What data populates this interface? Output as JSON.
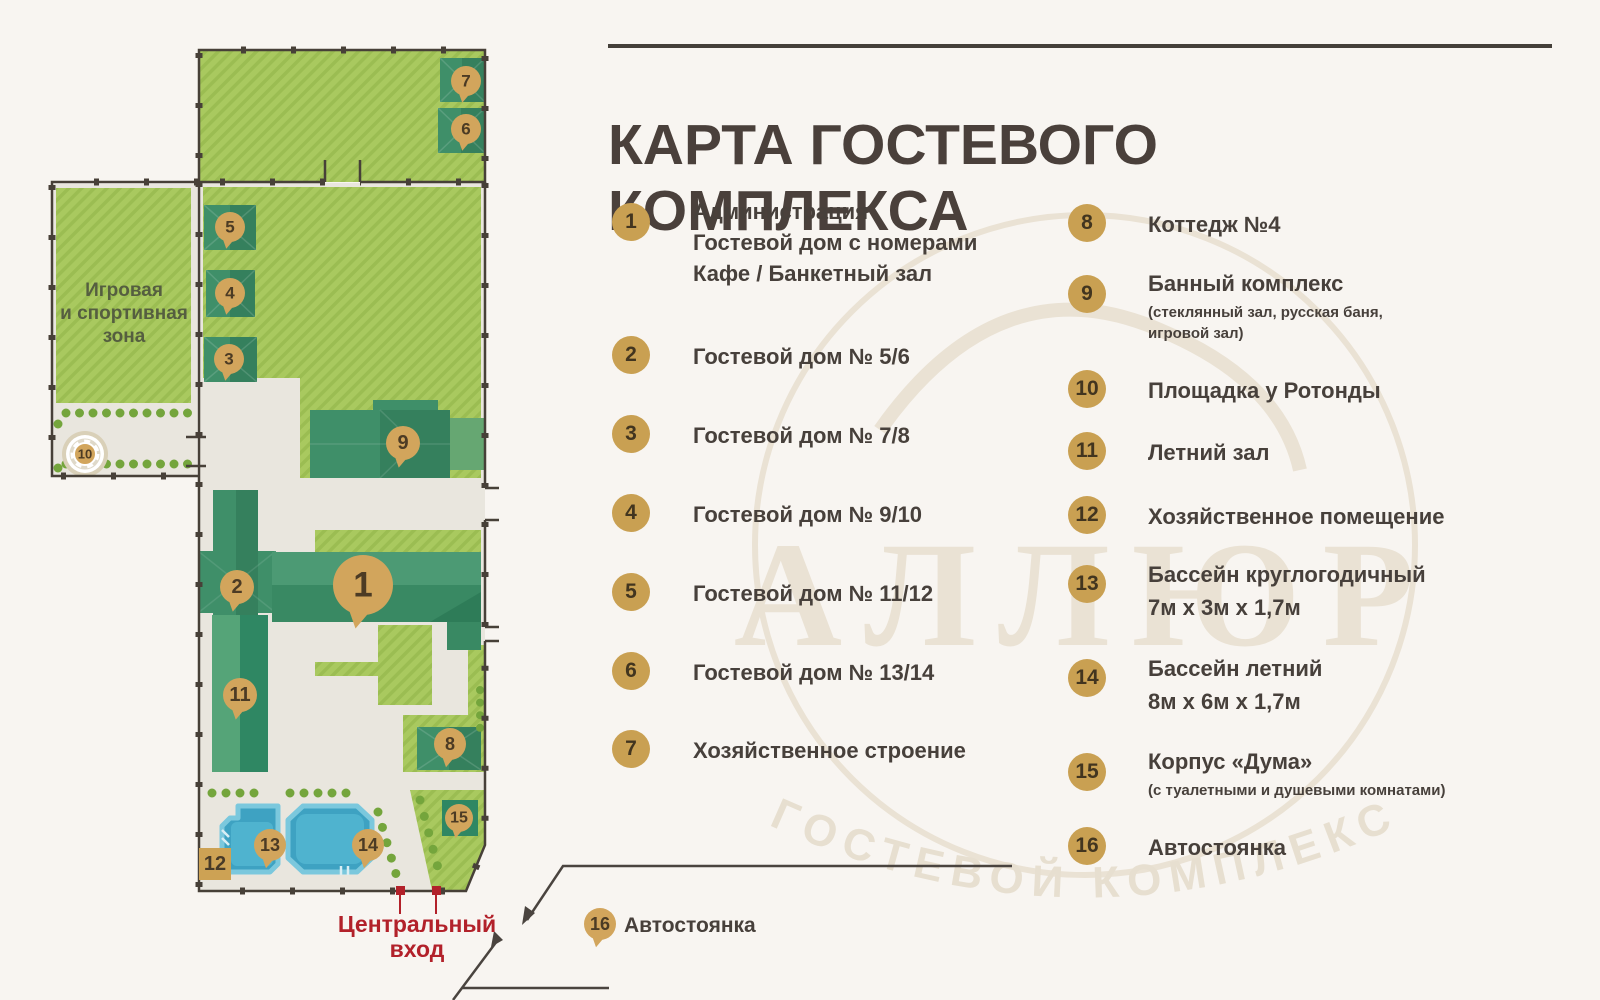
{
  "header": {
    "title": "КАРТА ГОСТЕВОГО КОМПЛЕКСА"
  },
  "map": {
    "zone_label": {
      "line1": "Игровая",
      "line2": "и спортивная",
      "line3": "зона"
    },
    "entrance": {
      "line1": "Центральный",
      "line2": "вход"
    },
    "parking_label": "Автостоянка",
    "storage_tag": "12",
    "markers": [
      {
        "n": "1",
        "x": 363,
        "y": 585,
        "r": 30
      },
      {
        "n": "2",
        "x": 237,
        "y": 587,
        "r": 17
      },
      {
        "n": "3",
        "x": 229,
        "y": 359,
        "r": 15
      },
      {
        "n": "4",
        "x": 230,
        "y": 293,
        "r": 15
      },
      {
        "n": "5",
        "x": 230,
        "y": 227,
        "r": 15
      },
      {
        "n": "6",
        "x": 466,
        "y": 129,
        "r": 15
      },
      {
        "n": "7",
        "x": 466,
        "y": 81,
        "r": 15
      },
      {
        "n": "8",
        "x": 450,
        "y": 744,
        "r": 16
      },
      {
        "n": "9",
        "x": 403,
        "y": 443,
        "r": 17
      },
      {
        "n": "10",
        "x": 85,
        "y": 454,
        "r": 11,
        "tail": false
      },
      {
        "n": "11",
        "x": 240,
        "y": 695,
        "r": 17
      },
      {
        "n": "13",
        "x": 270,
        "y": 845,
        "r": 16
      },
      {
        "n": "14",
        "x": 368,
        "y": 845,
        "r": 16
      },
      {
        "n": "15",
        "x": 459,
        "y": 818,
        "r": 14
      },
      {
        "n": "16",
        "x": 600,
        "y": 924,
        "r": 16
      }
    ]
  },
  "legend": {
    "left": [
      {
        "number": "1",
        "lines": [
          "Администрация",
          "Гостевой дом с номерами",
          "Кафе / Банкетный зал"
        ]
      },
      {
        "number": "2",
        "lines": [
          "Гостевой дом № 5/6"
        ]
      },
      {
        "number": "3",
        "lines": [
          "Гостевой дом № 7/8"
        ]
      },
      {
        "number": "4",
        "lines": [
          "Гостевой дом № 9/10"
        ]
      },
      {
        "number": "5",
        "lines": [
          "Гостевой дом № 11/12"
        ]
      },
      {
        "number": "6",
        "lines": [
          "Гостевой дом № 13/14"
        ]
      },
      {
        "number": "7",
        "lines": [
          "Хозяйственное строение"
        ]
      }
    ],
    "right": [
      {
        "number": "8",
        "lines": [
          "Коттедж №4"
        ]
      },
      {
        "number": "9",
        "lines": [
          "Банный комплекс"
        ],
        "note": "(стеклянный зал, русская баня, игровой зал)"
      },
      {
        "number": "10",
        "lines": [
          "Площадка у Ротонды"
        ]
      },
      {
        "number": "11",
        "lines": [
          "Летний зал"
        ]
      },
      {
        "number": "12",
        "lines": [
          "Хозяйственное помещение"
        ]
      },
      {
        "number": "13",
        "lines": [
          "Бассейн круглогодичный",
          "7м х 3м х 1,7м"
        ]
      },
      {
        "number": "14",
        "lines": [
          "Бассейн летний",
          "8м х 6м х 1,7м"
        ]
      },
      {
        "number": "15",
        "lines": [
          "Корпус «Дума»"
        ],
        "note": "(с туалетными и душевыми комнатами)"
      },
      {
        "number": "16",
        "lines": [
          "Автостоянка"
        ]
      }
    ]
  },
  "watermark": {
    "big_text": "АЛЛЮР",
    "arc_text": "ГОСТЕВОЙ КОМПЛЕКС"
  },
  "colors": {
    "background": "#F8F5F1",
    "accent_gold": "#C9A052",
    "marker_gold": "#D2A55C",
    "red": "#B2212A",
    "grass": "#A9C95F",
    "building_teal": "#3F8F69",
    "pool_blue": "#3EA2C2",
    "path": "#E9E6DE",
    "text_dark": "#47403B"
  }
}
